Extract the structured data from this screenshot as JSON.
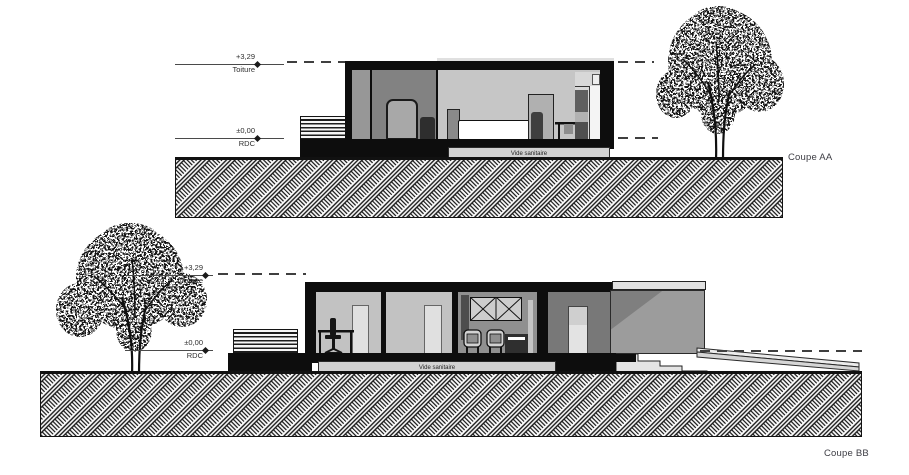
{
  "drawing": {
    "sections": [
      {
        "name": "Coupe AA",
        "levels": [
          {
            "value": "+3,29",
            "label": "Toiture"
          },
          {
            "value": "±0,00",
            "label": "RDC"
          }
        ],
        "crawl_space": "Vide sanitaire"
      },
      {
        "name": "Coupe BB",
        "levels": [
          {
            "value": "+3,29",
            "label": "Toiture"
          },
          {
            "value": "±0,00",
            "label": "RDC"
          }
        ],
        "crawl_space": "Vide sanitaire"
      }
    ],
    "colors": {
      "cut_black": "#0d0d0d",
      "terrace_gray": "#8a8a8a",
      "interior_light": "#c6c6c6",
      "panel_light": "#e0e0e0",
      "crawl_space_band": "#d2d2d2",
      "level_line": "#4a4a4a",
      "background": "#ffffff"
    }
  }
}
